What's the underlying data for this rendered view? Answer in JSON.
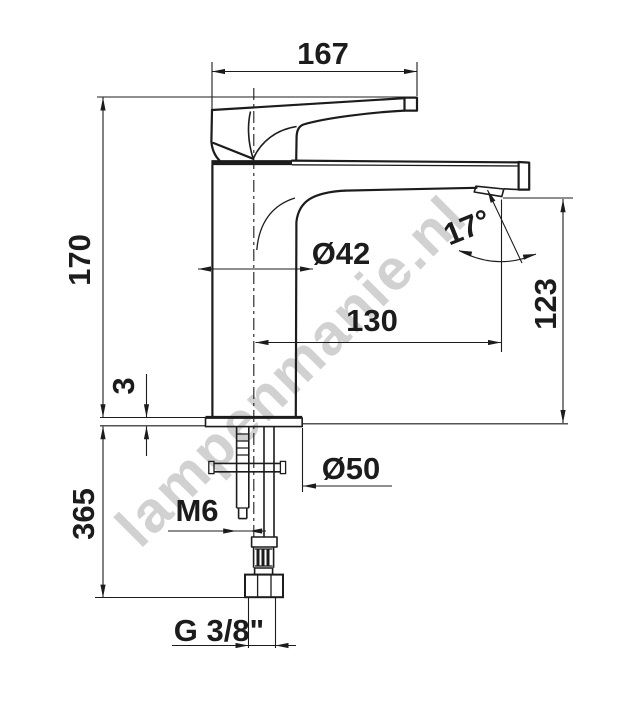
{
  "drawing": {
    "subject": "Single-lever basin mixer tap, side elevation with installation dimensions",
    "watermark": "lampenmanie.nl",
    "dimensions": {
      "lever_length_mm": "167",
      "spout_tip_height_mm": "170",
      "body_diameter": "Ø42",
      "spout_reach_mm": "130",
      "outlet_height_mm": "123",
      "outlet_angle": "17°",
      "deck_plate_thickness_mm": "3",
      "deck_plate_diameter": "Ø50",
      "fixing_bolt_thread": "M6",
      "supply_hose_length_mm": "365",
      "connection_thread": "G 3/8\""
    },
    "colors": {
      "line": "#1c1c1c",
      "background": "#ffffff",
      "watermark": "#c6c6c6"
    }
  }
}
